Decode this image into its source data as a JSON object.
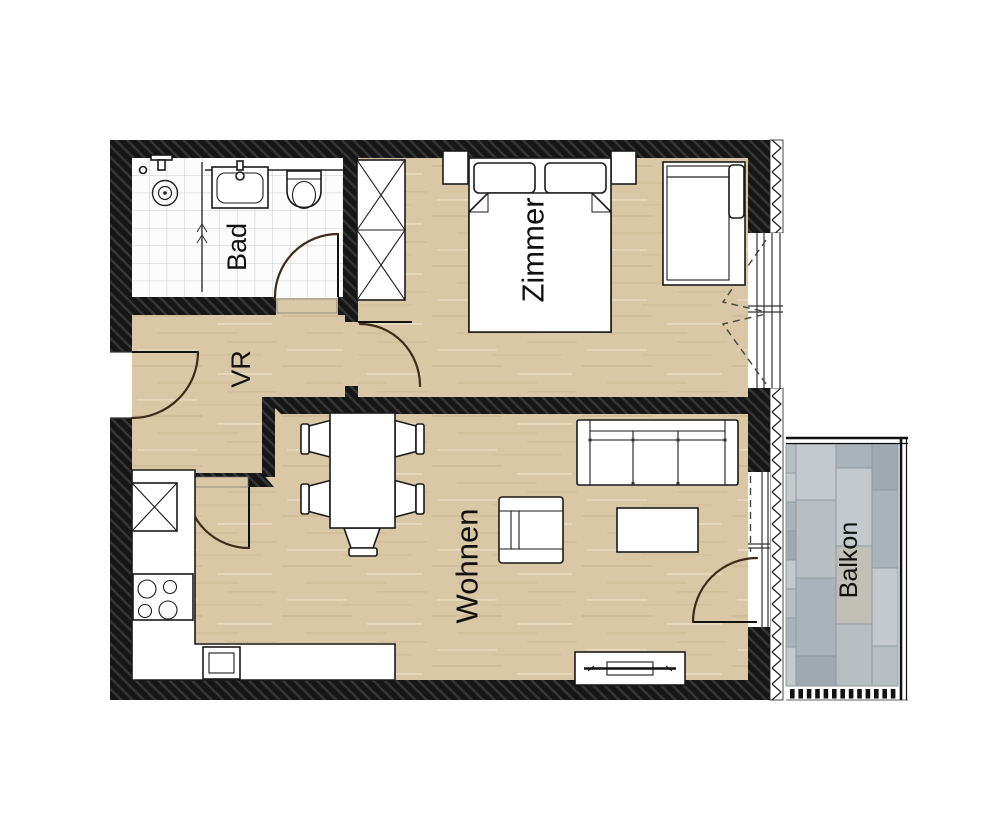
{
  "rooms": {
    "bathroom": {
      "label": "Bad"
    },
    "hallway": {
      "label": "VR"
    },
    "bedroom": {
      "label": "Zimmer"
    },
    "living_room": {
      "label": "Wohnen"
    },
    "balcony": {
      "label": "Balkon"
    }
  },
  "colors": {
    "wall": "#161616",
    "wall_hatch_line": "#363636",
    "floor_wood": "#d9c7a6",
    "wood_streak_dark": "#c7b186",
    "wood_streak_light": "#ecdfc4",
    "bath_tile": "#fcfcfc",
    "bath_tile_line": "#c9c9c9",
    "door_arc": "#3e2c18",
    "outline": "#1a1a1a",
    "label_text": "#111111",
    "balcony_tile_a": "#b7bfc3",
    "balcony_tile_b": "#a9b3b9",
    "balcony_tile_c": "#c3c9cc",
    "balcony_tile_d": "#9fa9af",
    "balcony_tile_e": "#c1c0b6",
    "balcony_joint": "#8f999e",
    "railing": "#111111",
    "insulation_line": "#1a1a1a"
  }
}
